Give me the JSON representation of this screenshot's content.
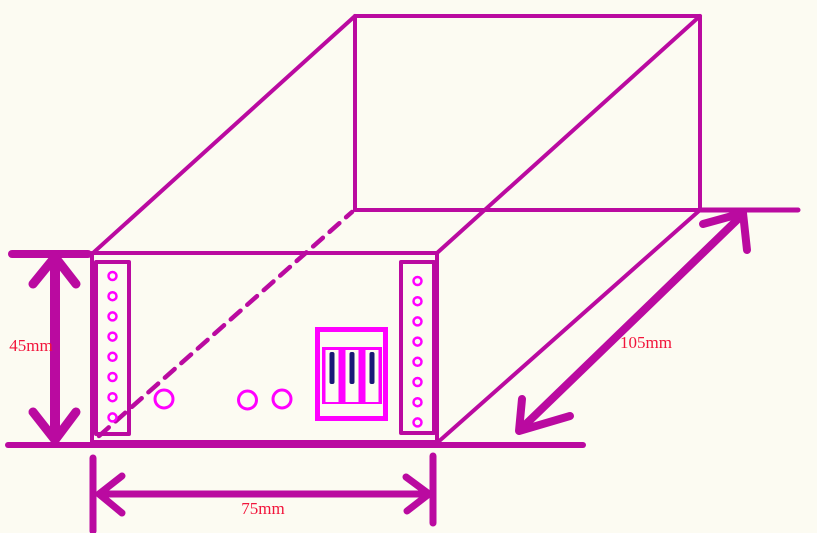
{
  "diagram": {
    "type": "isometric-wireframe-sketch",
    "object": "rack enclosure box",
    "labels": {
      "height": "45mm",
      "width": "75mm",
      "depth": "105mm"
    }
  },
  "dimensions": {
    "height_mm": 45,
    "width_mm": 75,
    "depth_mm": 105
  },
  "front_panel": {
    "left_ear_hole_count": 8,
    "right_ear_hole_count": 8,
    "panel_hole_count": 3,
    "connector_slot_count": 3
  },
  "colors": {
    "background": "#FCFBF2",
    "outline": "#BA0AA0",
    "accent_magenta": "#FF00FF",
    "connector_pin_navy": "#191975",
    "dimension_text_red": "#F2143B"
  }
}
